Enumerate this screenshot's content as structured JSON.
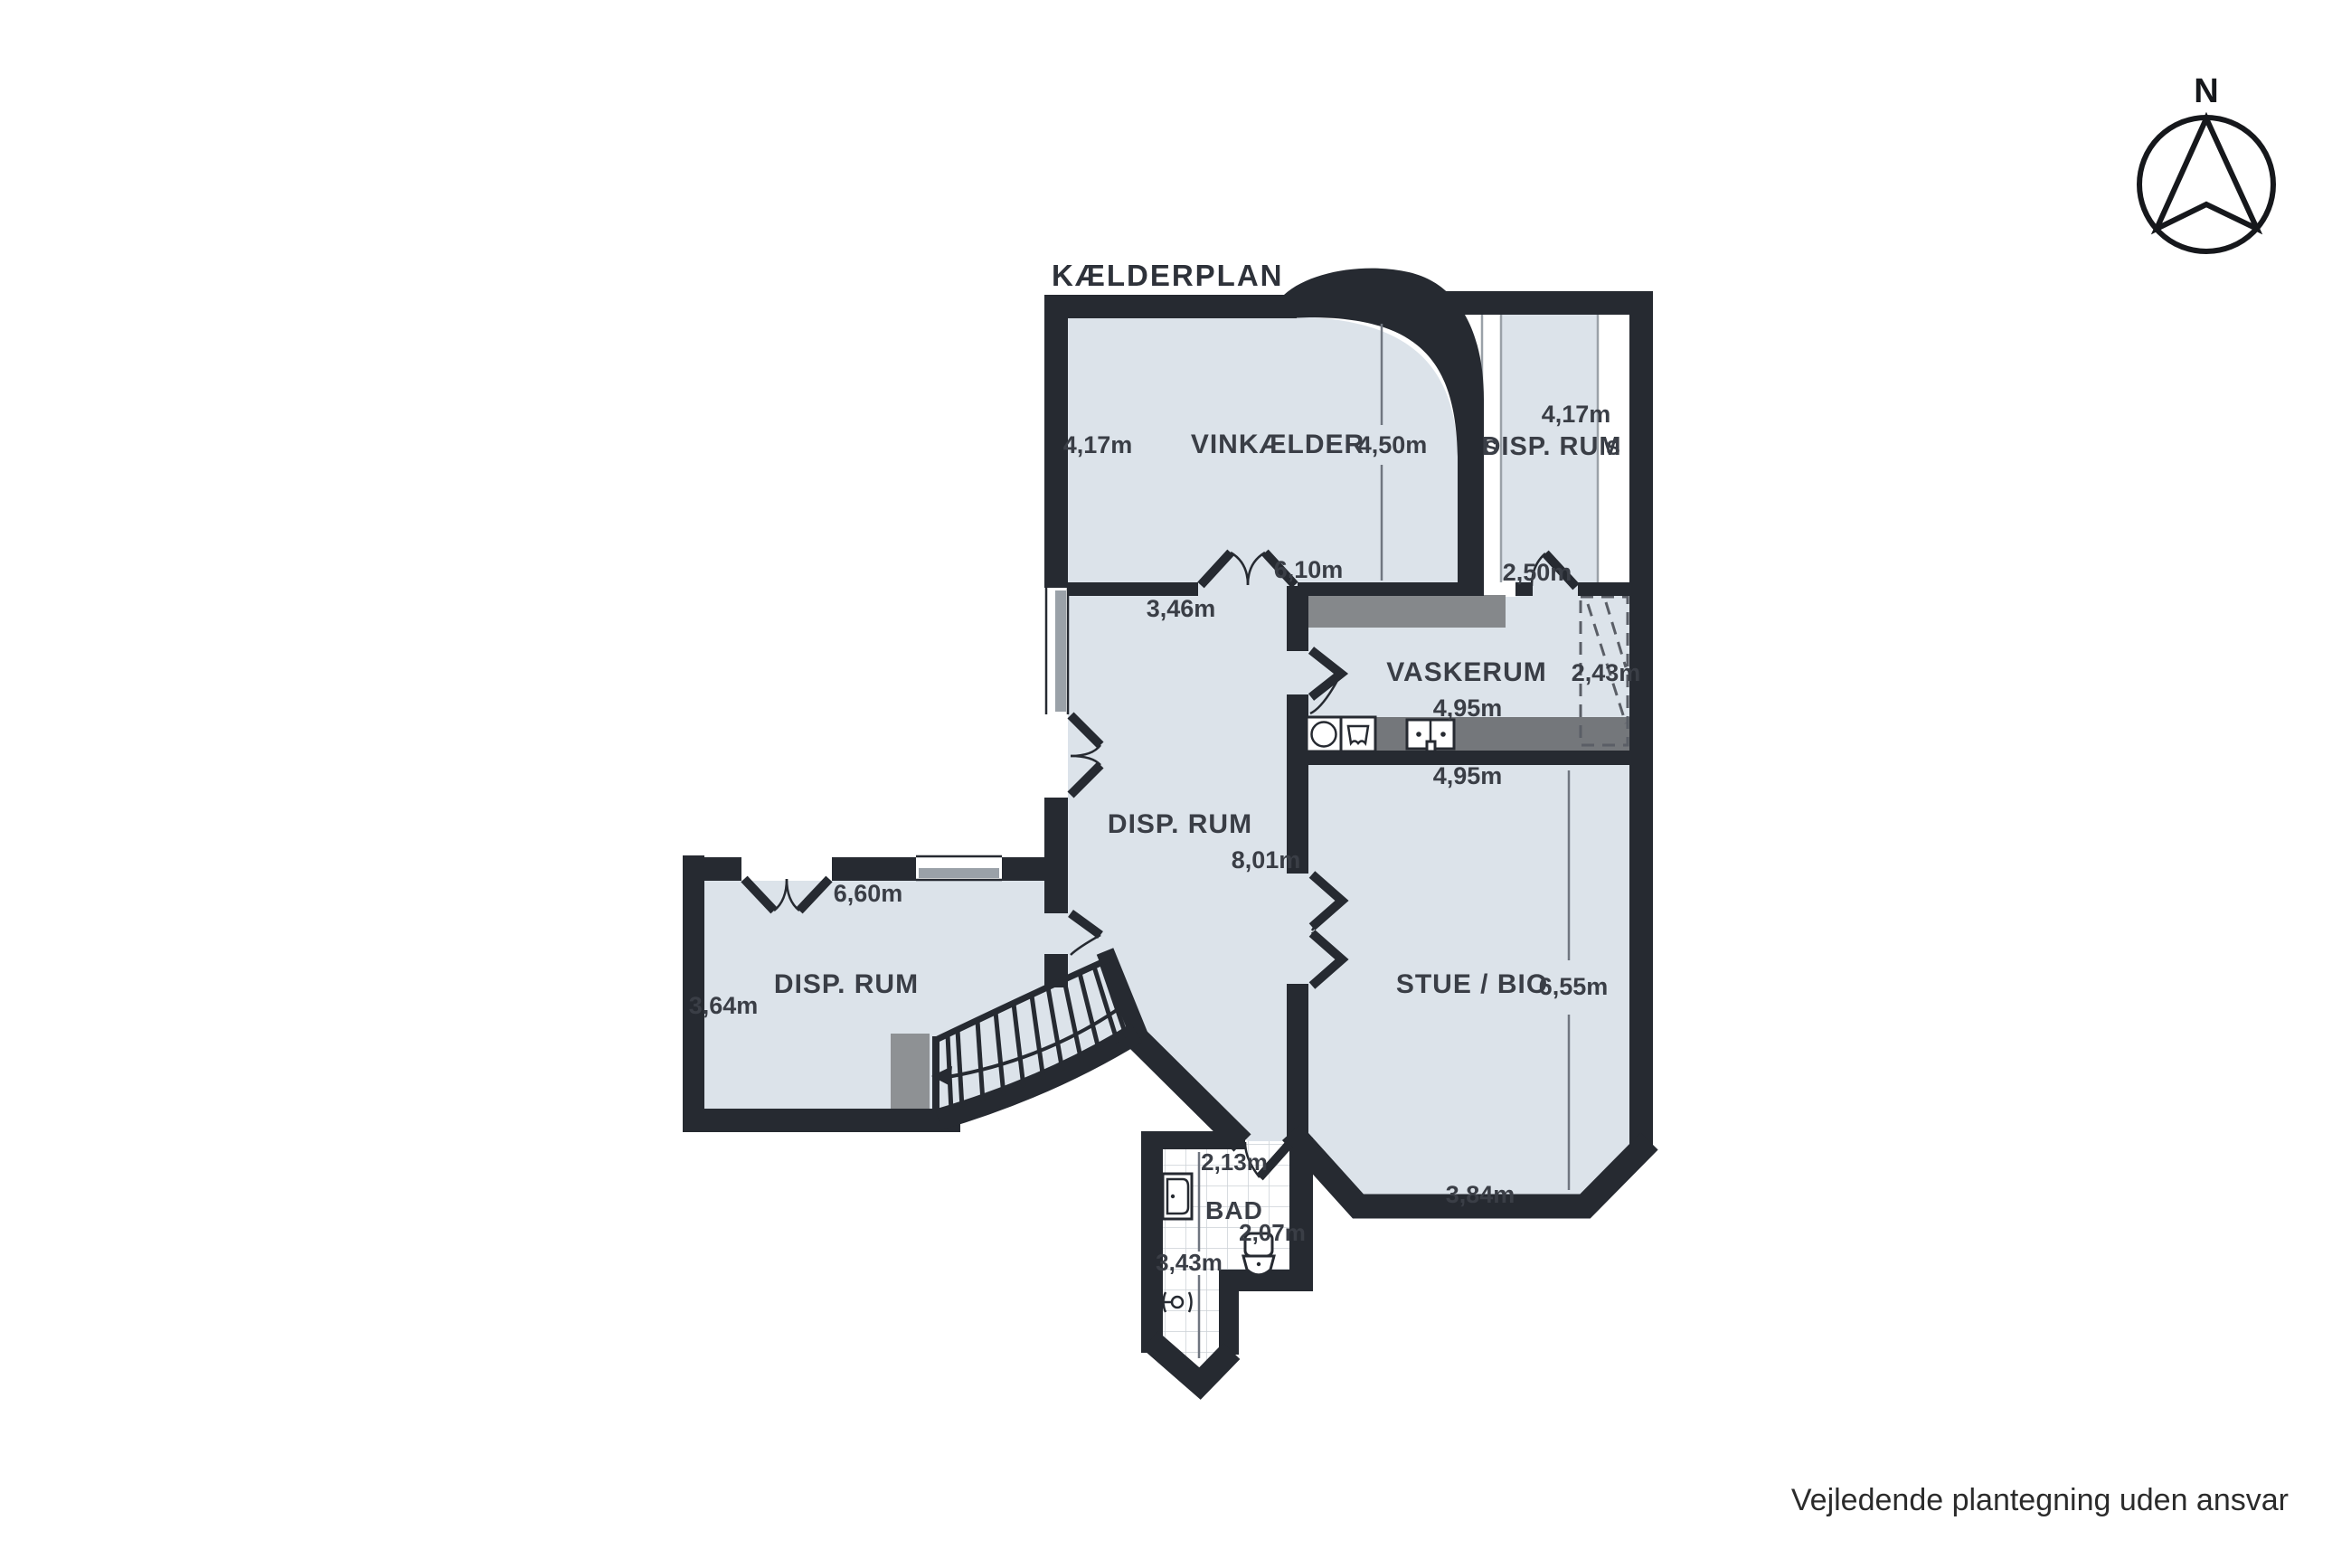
{
  "title": "KÆLDERPLAN",
  "compass": {
    "label": "N"
  },
  "footer": "Vejledende plantegning uden ansvar",
  "colors": {
    "wall": "#262a31",
    "floor": "#dce3ea",
    "counter_dark": "#85888b",
    "counter_mid": "#74777b",
    "block_gray": "#8e9194",
    "tile_line": "#ccd1d6",
    "window_gray": "#9aa1a8",
    "text": "#3a3e46"
  },
  "rooms": [
    {
      "id": "vinkaelder",
      "label": "VINKÆLDER",
      "measurements": [
        "4,17m",
        "4,50m",
        "6,10m"
      ]
    },
    {
      "id": "disp-rum-top",
      "label": "DISP. RUM",
      "measurements": [
        "4,17m",
        "2,50m"
      ],
      "closet_marks": [
        "S",
        "S"
      ]
    },
    {
      "id": "vaskerum",
      "label": "VASKERUM",
      "measurements": [
        "4,95m",
        "2,43m"
      ]
    },
    {
      "id": "disp-rum-mid",
      "label": "DISP. RUM",
      "measurements": [
        "3,46m",
        "8,01m"
      ]
    },
    {
      "id": "stue-bio",
      "label": "STUE / BIO",
      "measurements": [
        "4,95m",
        "6,55m",
        "3,84m"
      ]
    },
    {
      "id": "disp-rum-left",
      "label": "DISP. RUM",
      "measurements": [
        "6,60m",
        "3,64m"
      ]
    },
    {
      "id": "bad",
      "label": "BAD",
      "measurements": [
        "2,13m",
        "2,07m",
        "3,43m"
      ]
    }
  ]
}
